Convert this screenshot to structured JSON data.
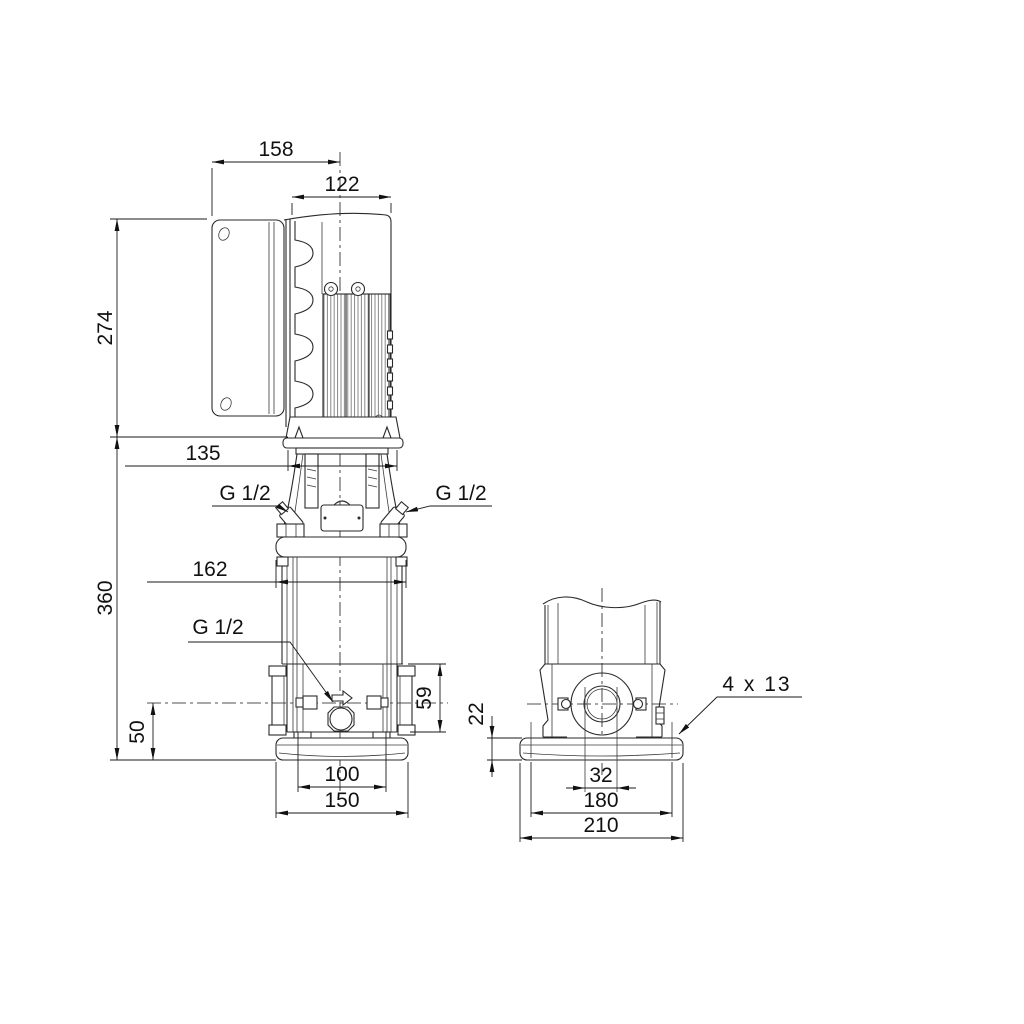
{
  "dimensions": {
    "front_view": {
      "total_width": "158",
      "motor_width": "122",
      "motor_height": "274",
      "head_width": "135",
      "pump_height": "360",
      "flange_width": "162",
      "port_center_height": "50",
      "chamber_height": "59",
      "foot_hole_spacing": "100",
      "base_width": "150",
      "vent_plug_left": "G 1/2",
      "vent_plug_right": "G 1/2",
      "drain_plug": "G 1/2"
    },
    "side_view": {
      "base_height": "22",
      "port_bore": "32",
      "bolt_hole_spacing": "180",
      "base_depth": "210",
      "bolt_holes": "4 x 13"
    }
  }
}
